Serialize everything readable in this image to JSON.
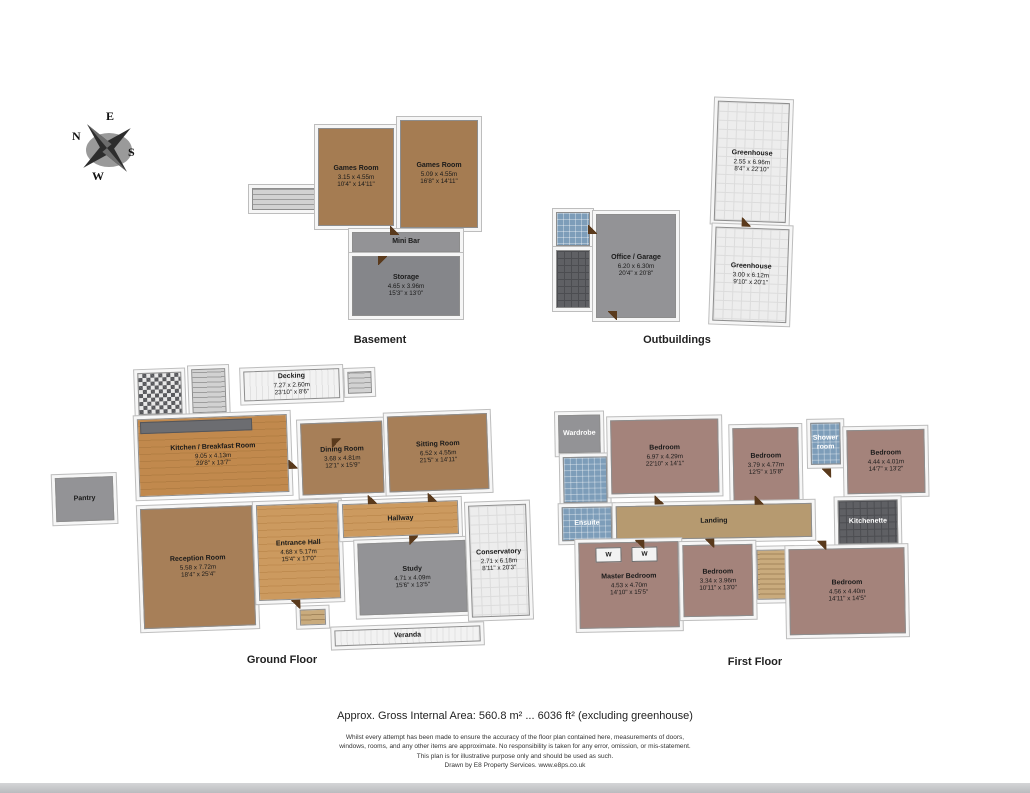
{
  "page": {
    "area_note": "Approx. Gross Internal Area: 560.8 m² ... 6036 ft²  (excluding greenhouse)",
    "disclaimer_1": "Whilst every attempt has been made to ensure the accuracy of the floor plan contained here, measurements of doors,",
    "disclaimer_2": "windows, rooms, and any other items are approximate. No responsibility is taken for any error, omission, or mis-statement.",
    "disclaimer_3": "This plan is for illustrative purpose only and should be used as such.",
    "credit": "Drawn by E8 Property Services. www.e8ps.co.uk"
  },
  "compass": {
    "n": "N",
    "e": "E",
    "s": "S",
    "w": "W"
  },
  "sections": {
    "basement": "Basement",
    "outbuildings": "Outbuildings",
    "ground_floor": "Ground Floor",
    "first_floor": "First Floor"
  },
  "colors": {
    "wood_floor": "#c1894d",
    "carpet_brown": "#a77f58",
    "carpet_mauve": "#a4837b",
    "tile_blue": "#7d9db9",
    "floor_gray": "#939396",
    "landing_tan": "#b69a70",
    "greenhouse_tile": "#ededed",
    "door_brown": "#5a3a1c"
  },
  "rooms": {
    "games_room_1": {
      "name": "Games Room",
      "m": "3.15 x 4.55m",
      "ft": "10'4\" x 14'11\""
    },
    "games_room_2": {
      "name": "Games Room",
      "m": "5.09 x 4.55m",
      "ft": "16'8\" x 14'11\""
    },
    "mini_bar": {
      "name": "Mini Bar"
    },
    "storage": {
      "name": "Storage",
      "m": "4.65 x 3.96m",
      "ft": "15'3\" x 13'0\""
    },
    "office_garage": {
      "name": "Office / Garage",
      "m": "6.20 x 6.30m",
      "ft": "20'4\" x 20'8\""
    },
    "greenhouse_1": {
      "name": "Greenhouse",
      "m": "2.55 x 6.96m",
      "ft": "8'4\" x 22'10\""
    },
    "greenhouse_2": {
      "name": "Greenhouse",
      "m": "3.00 x 6.12m",
      "ft": "9'10\" x 20'1\""
    },
    "decking": {
      "name": "Decking",
      "m": "7.27 x 2.60m",
      "ft": "23'10\" x 8'6\""
    },
    "kitchen_breakfast": {
      "name": "Kitchen / Breakfast Room",
      "m": "9.05 x 4.13m",
      "ft": "29'8\" x 13'7\""
    },
    "dining_room": {
      "name": "Dining Room",
      "m": "3.68 x 4.81m",
      "ft": "12'1\" x 15'9\""
    },
    "sitting_room": {
      "name": "Sitting Room",
      "m": "6.52 x 4.55m",
      "ft": "21'5\" x 14'11\""
    },
    "pantry": {
      "name": "Pantry"
    },
    "reception_room": {
      "name": "Reception Room",
      "m": "5.58 x 7.72m",
      "ft": "18'4\" x 25'4\""
    },
    "entrance_hall": {
      "name": "Entrance Hall",
      "m": "4.68 x 5.17m",
      "ft": "15'4\" x 17'0\""
    },
    "hallway": {
      "name": "Hallway"
    },
    "study": {
      "name": "Study",
      "m": "4.71 x 4.09m",
      "ft": "15'6\" x 13'5\""
    },
    "conservatory": {
      "name": "Conservatory",
      "m": "2.71 x 6.18m",
      "ft": "8'11\" x 20'3\""
    },
    "veranda": {
      "name": "Veranda"
    },
    "wardrobe": {
      "name": "Wardrobe"
    },
    "bedroom_1": {
      "name": "Bedroom",
      "m": "6.97 x 4.29m",
      "ft": "22'10\" x 14'1\""
    },
    "bedroom_2": {
      "name": "Bedroom",
      "m": "3.79 x 4.77m",
      "ft": "12'5\" x 15'8\""
    },
    "shower_room": {
      "name": "Shower room"
    },
    "bedroom_3": {
      "name": "Bedroom",
      "m": "4.44 x 4.01m",
      "ft": "14'7\" x 13'2\""
    },
    "ensuite": {
      "name": "Ensuite"
    },
    "landing": {
      "name": "Landing"
    },
    "kitchenette": {
      "name": "Kitchenette"
    },
    "master_bedroom": {
      "name": "Master Bedroom",
      "m": "4.53 x 4.70m",
      "ft": "14'10\" x 15'5\""
    },
    "bedroom_4": {
      "name": "Bedroom",
      "m": "3.34 x 3.96m",
      "ft": "10'11\" x 13'0\""
    },
    "bedroom_5": {
      "name": "Bedroom",
      "m": "4.56 x 4.40m",
      "ft": "14'11\" x 14'5\""
    },
    "wardrobe_marker": "W"
  }
}
